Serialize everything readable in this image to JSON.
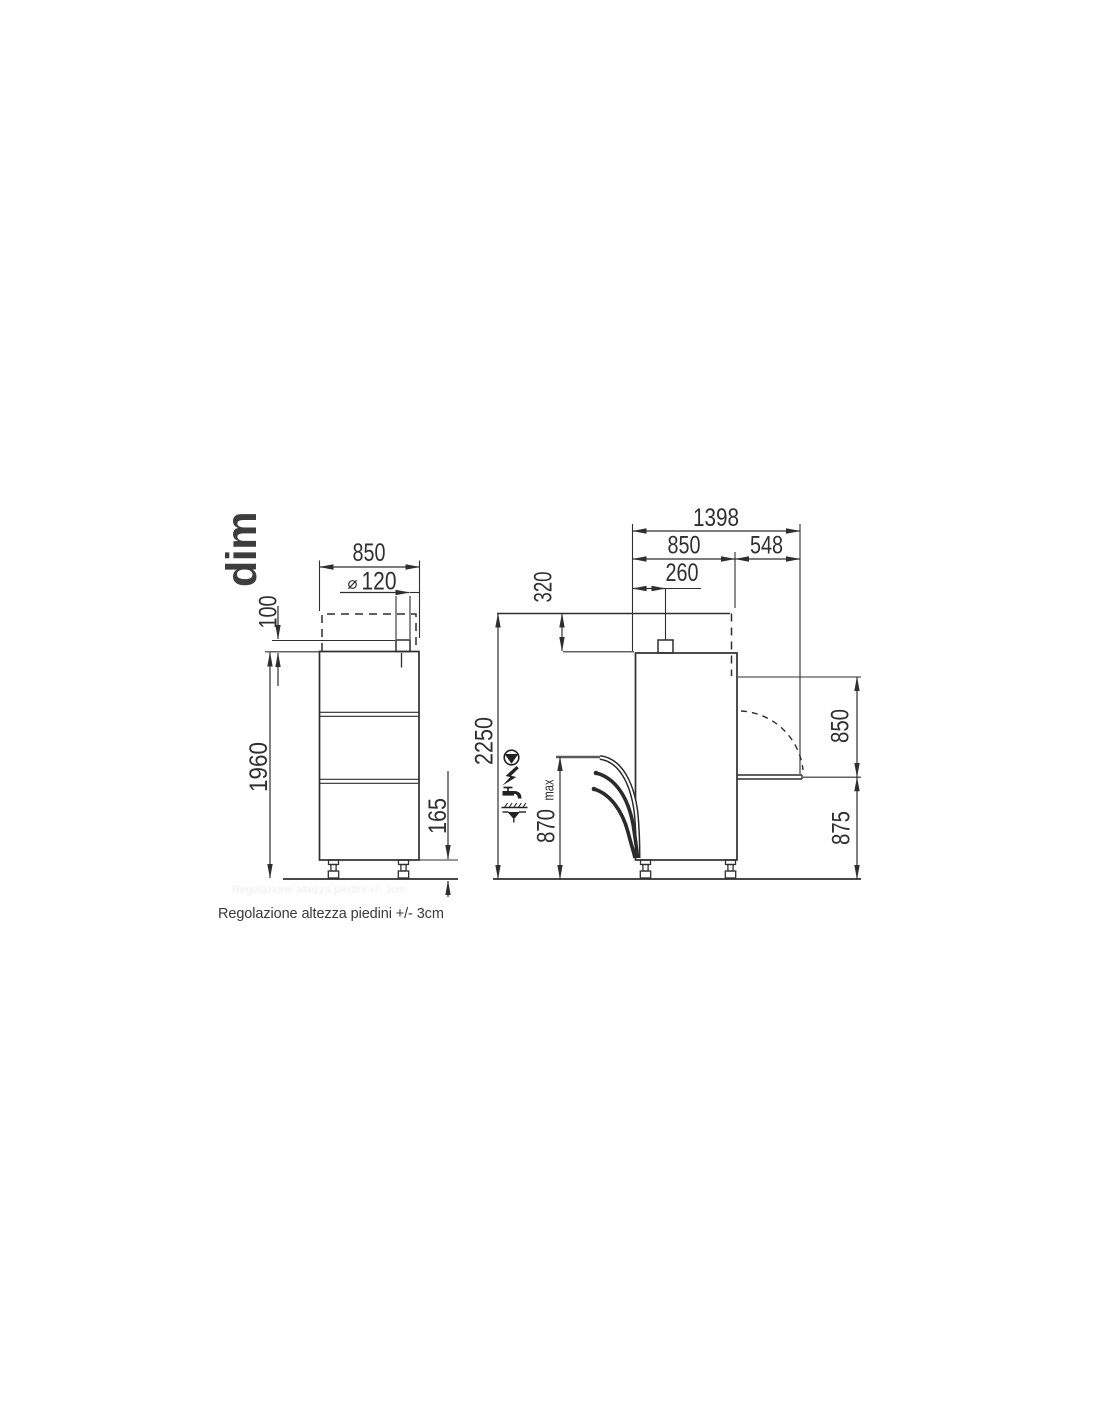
{
  "title": "dim",
  "caption": "Regolazione altezza piedini +/- 3cm",
  "front_view": {
    "width_mm": "850",
    "vent_diameter_mm": "120",
    "vent_stub_height_mm": "100",
    "height_mm": "1960",
    "feet_height_mm": "165"
  },
  "side_view": {
    "total_depth_mm": "1398",
    "body_depth_mm": "850",
    "table_extension_mm": "548",
    "vent_offset_mm": "260",
    "hood_travel_mm": "320",
    "total_height_hood_open_mm": "2250",
    "connections_max_height_mm": "870",
    "connections_max_suffix": "max",
    "hood_opening_height_mm": "850",
    "table_height_mm": "875"
  },
  "colors": {
    "line": "#2f2f2f",
    "text": "#2f2f2f",
    "background": "#ffffff"
  }
}
